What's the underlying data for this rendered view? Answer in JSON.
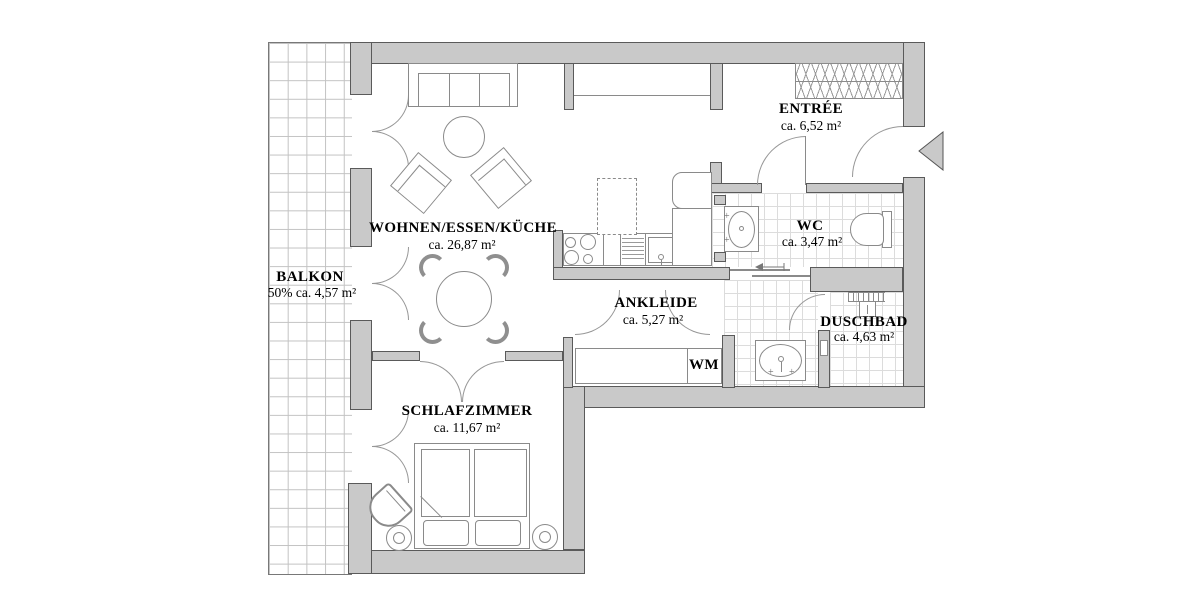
{
  "rooms": {
    "balkon": {
      "name": "BALKON",
      "area": "50% ca. 4,57 m²"
    },
    "wohnen": {
      "name": "WOHNEN/ESSEN/KÜCHE",
      "area": "ca. 26,87 m²"
    },
    "entree": {
      "name": "ENTRÉE",
      "area": "ca. 6,52 m²"
    },
    "wc": {
      "name": "WC",
      "area": "ca. 3,47 m²"
    },
    "ankleide": {
      "name": "ANKLEIDE",
      "area": "ca. 5,27 m²"
    },
    "duschbad": {
      "name": "DUSCHBAD",
      "area": "ca. 4,63 m²"
    },
    "schlafzimmer": {
      "name": "SCHLAFZIMMER",
      "area": "ca. 11,67 m²"
    },
    "wm": {
      "name": "WM"
    }
  },
  "symbols": {
    "plus": "+"
  },
  "colors": {
    "wall_fill": "#c9c9c9",
    "wall_outline": "#5a5a5a",
    "furniture_line": "#8a8a8a",
    "tile_line": "#dcdcdc",
    "balcony_grid": "#c2c2c2",
    "text": "#000000",
    "background": "#ffffff"
  }
}
